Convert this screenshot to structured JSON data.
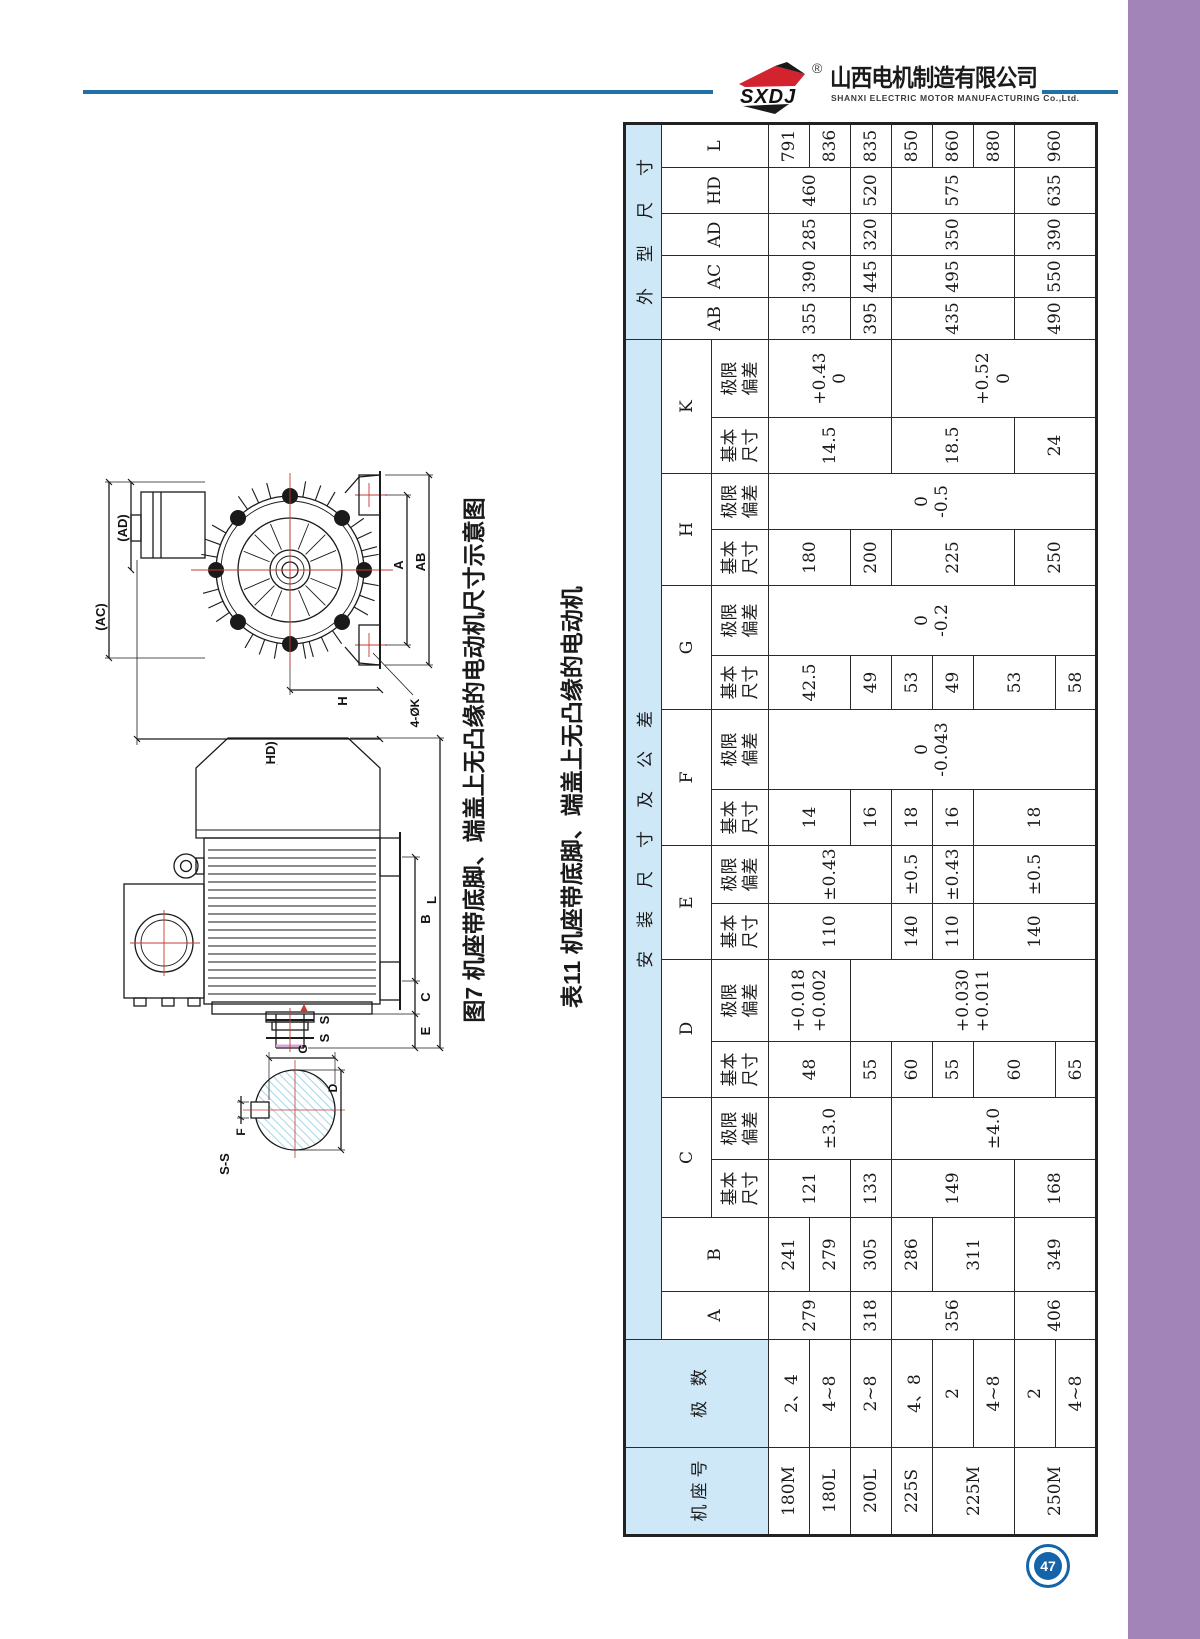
{
  "page": {
    "number": "47"
  },
  "header": {
    "logo_text": "SXDJ",
    "registered_mark": "®",
    "company_cn": "山西电机制造有限公司",
    "company_en": "SHANXI ELECTRIC MOTOR MANUFACTURING Co.,Ltd.",
    "accent_blue": "#2171a6",
    "logo_red": "#d2232e"
  },
  "figure": {
    "caption": "图7 机座带底脚、端盖上无凸缘的电动机尺寸示意图",
    "end_view_labels": {
      "hd": "(HD)",
      "h": "H",
      "ac": "(AC)",
      "ad": "(AD)",
      "a": "A",
      "ab": "AB",
      "k_holes": "4-ØK"
    },
    "side_view_labels": {
      "b": "B",
      "c": "C",
      "e": "E",
      "l": "L",
      "s1": "S",
      "s2": "S"
    },
    "section_labels": {
      "title": "S-S",
      "f": "F",
      "g": "G",
      "d": "D"
    }
  },
  "table": {
    "caption": "表11 机座带底脚、端盖上无凸缘的电动机",
    "headers": {
      "frame": "机座号",
      "poles": "极 数",
      "install_group": "安装尺寸及公差",
      "outline_group": "外型尺寸",
      "basic": "基本\n尺寸",
      "limit": "极限\n偏差",
      "A": "A",
      "B": "B",
      "C": "C",
      "D": "D",
      "E": "E",
      "F": "F",
      "G": "G",
      "H": "H",
      "K": "K",
      "AB": "AB",
      "AC": "AC",
      "AD": "AD",
      "HD": "HD",
      "L": "L"
    },
    "frames": [
      "180M",
      "180L",
      "200L",
      "225S",
      "225M",
      "250M"
    ],
    "poles": [
      "2、4",
      "4~8",
      "2~8",
      "4、8",
      "2",
      "4~8",
      "2",
      "4~8"
    ],
    "A": [
      "279",
      "318",
      "356",
      "406"
    ],
    "B": [
      "241",
      "279",
      "305",
      "286",
      "311",
      "349"
    ],
    "C_basic": [
      "121",
      "133",
      "149",
      "168"
    ],
    "C_limit": [
      "±3.0",
      "±4.0"
    ],
    "D_basic": [
      "48",
      "55",
      "60",
      "55",
      "60",
      "65"
    ],
    "D_limit": [
      "+0.018\n+0.002",
      "+0.030\n+0.011"
    ],
    "E_basic": [
      "110",
      "140",
      "110",
      "140"
    ],
    "E_limit": [
      "±0.43",
      "±0.5",
      "±0.43",
      "±0.5"
    ],
    "F_basic": [
      "14",
      "16",
      "18",
      "16",
      "18"
    ],
    "F_limit": "0\n-0.043",
    "G_basic": [
      "42.5",
      "49",
      "53",
      "49",
      "53",
      "58"
    ],
    "G_limit": "0\n-0.2",
    "H_basic": [
      "180",
      "200",
      "225",
      "250"
    ],
    "H_limit": "0\n-0.5",
    "K_basic": [
      "14.5",
      "18.5",
      "24"
    ],
    "K_limit": [
      "+0.43\n0",
      "+0.52\n0"
    ],
    "AB": [
      "355",
      "395",
      "435",
      "490"
    ],
    "AC": [
      "390",
      "445",
      "495",
      "550"
    ],
    "AD": [
      "285",
      "320",
      "350",
      "390"
    ],
    "HD": [
      "460",
      "520",
      "575",
      "635"
    ],
    "L": [
      "791",
      "836",
      "835",
      "850",
      "860",
      "880",
      "960"
    ]
  }
}
